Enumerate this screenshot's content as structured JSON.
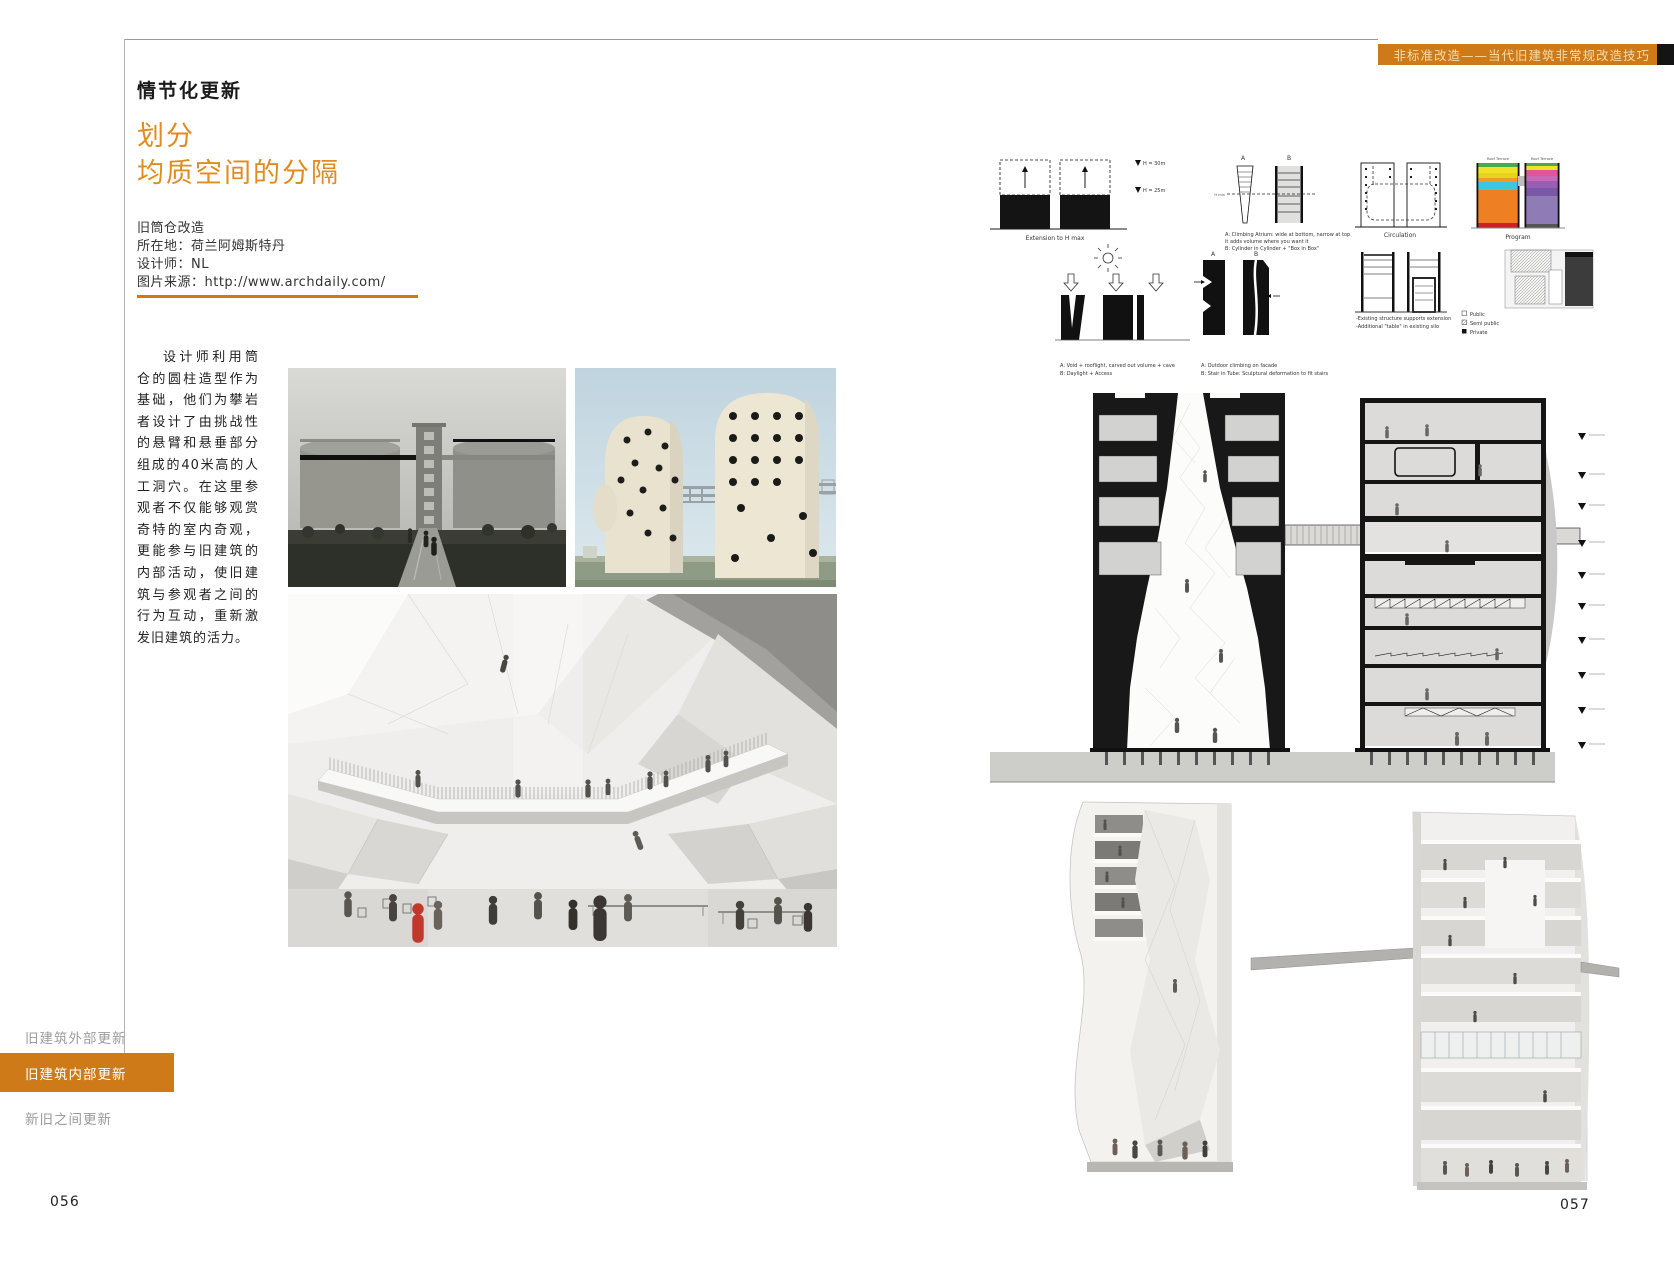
{
  "colors": {
    "accent": "#CE7A19",
    "accent_text": "#F7DCAC",
    "title": "#E08C1F",
    "nav_inactive": "#9C9C9C",
    "rule": "#9A9A9A"
  },
  "header": {
    "title": "非标准改造——当代旧建筑非常规改造技巧"
  },
  "left_page": {
    "page_number": "056",
    "section_label": "情节化更新",
    "title_lines": [
      "划分",
      "均质空间的分隔"
    ],
    "project_info": {
      "name": "旧筒仓改造",
      "location": "所在地：荷兰阿姆斯特丹",
      "designer": "设计师：NL",
      "source": "图片来源：http://www.archdaily.com/"
    },
    "body_text": "设计师利用筒仓的圆柱造型作为基础，他们为攀岩者设计了由挑战性的悬臂和悬垂部分组成的40米高的人工洞穴。在这里参观者不仅能够观赏奇特的室内奇观，更能参与旧建筑的内部活动，使旧建筑与参观者之间的行为互动，重新激发旧建筑的活力。"
  },
  "sidebar_nav": {
    "items": [
      {
        "label": "旧建筑外部更新",
        "active": false
      },
      {
        "label": "旧建筑内部更新",
        "active": true
      },
      {
        "label": "新旧之间更新",
        "active": false
      }
    ]
  },
  "right_page": {
    "page_number": "057",
    "diagrams": {
      "extension": {
        "caption": "Extension to H max",
        "label_h30": "H = 30m",
        "label_h25": "H = 25m"
      },
      "atrium": {
        "letter_a": "A",
        "letter_b": "B",
        "label_hmin": "H min",
        "caption_line1": "A: Climbing Atrium: wide at bottom, narrow at top",
        "caption_line2": "it adds volume where you want it",
        "caption_line3": "B: Cylinder in Cylinder + \"Box in Box\""
      },
      "circulation": {
        "caption": "Circulation"
      },
      "program": {
        "caption": "Program",
        "roof_label": "Roof Terrace"
      },
      "daylight": {
        "caption_line1": "A: Void + rooflight, carved out volume + cave",
        "caption_line2": "B: Daylight + Access"
      },
      "climbing": {
        "letter_a": "A",
        "letter_b": "B",
        "caption_line1": "A: Outdoor climbing on facade",
        "caption_line2": "B: Stair in Tube: Sculptural deformation to fit stairs"
      },
      "structure": {
        "caption_line1": "-Existing structure supports extension",
        "caption_line2": "-Additional \"table\" in existing silo"
      },
      "legend": {
        "items": [
          "Public",
          "Semi public",
          "Private"
        ]
      }
    }
  }
}
